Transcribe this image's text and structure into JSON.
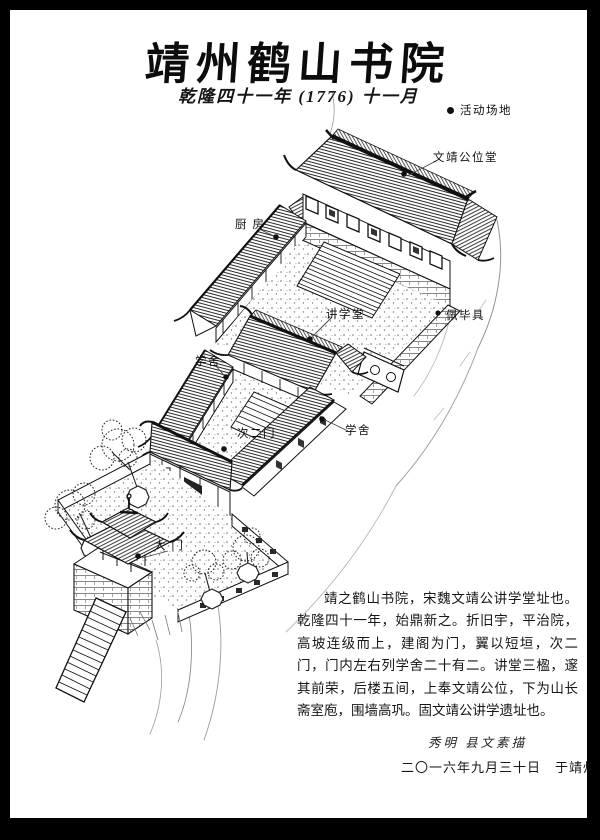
{
  "page": {
    "title": "靖州鹤山书院",
    "subtitle": "乾隆四十一年 (1776) 十一月"
  },
  "labels": {
    "activity_ground": "活动场地",
    "wenjing_hall": "文靖公位堂",
    "kitchen": "厨 房",
    "lecture_hall": "讲学堂",
    "peibiju": "佩毕具",
    "dorm_left": "学舍",
    "second_gate": "次二门",
    "dorm_right": "学舍",
    "main_gate": "大 门"
  },
  "description": {
    "text": "靖之鹤山书院，宋魏文靖公讲学堂址也。乾隆四十一年，始鼎新之。折旧宇，平治院，高坡连级而上，建阁为门，翼以短垣，次二门，门内左右列学舍二十有二。讲堂三楹，邃其前荣，后楼五间，上奉文靖公位，下为山长斋室庖，围墙高巩。固文靖公讲学遗址也。"
  },
  "signature": {
    "line1": "秀明 县文素描",
    "line2": "二〇一六年九月三十日　于靖州"
  },
  "colors": {
    "ink": "#1a1a1a",
    "paper": "#ffffff",
    "frame": "#000000"
  }
}
